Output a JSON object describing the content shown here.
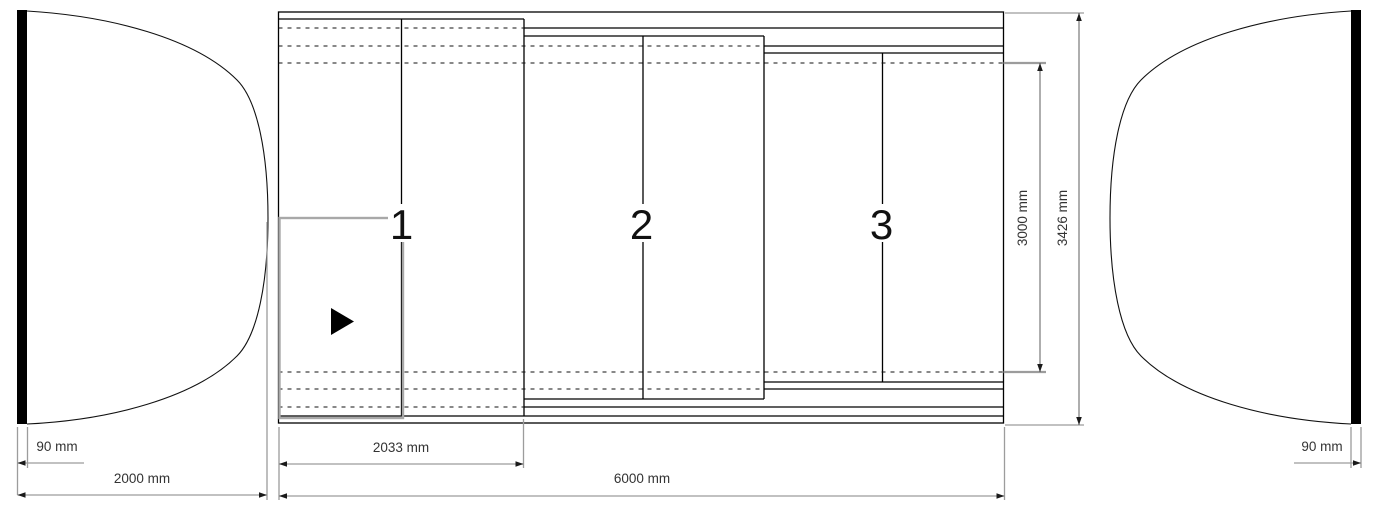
{
  "drawing": {
    "title": "telescopic-pool-enclosure-plan",
    "sections": [
      {
        "label": "1"
      },
      {
        "label": "2"
      },
      {
        "label": "3"
      }
    ],
    "dimensions": {
      "left_wall_thickness": "90 mm",
      "left_end_length": "2000 mm",
      "segment1_length": "2033 mm",
      "total_length": "6000 mm",
      "inner_width": "3000 mm",
      "outer_width": "3426 mm",
      "right_wall_thickness": "90 mm"
    },
    "colors": {
      "line": "#000000",
      "dimension_line": "#9c9c9c",
      "dimension_text": "#333333",
      "highlight": "#a8a8a8",
      "background": "#ffffff"
    }
  }
}
